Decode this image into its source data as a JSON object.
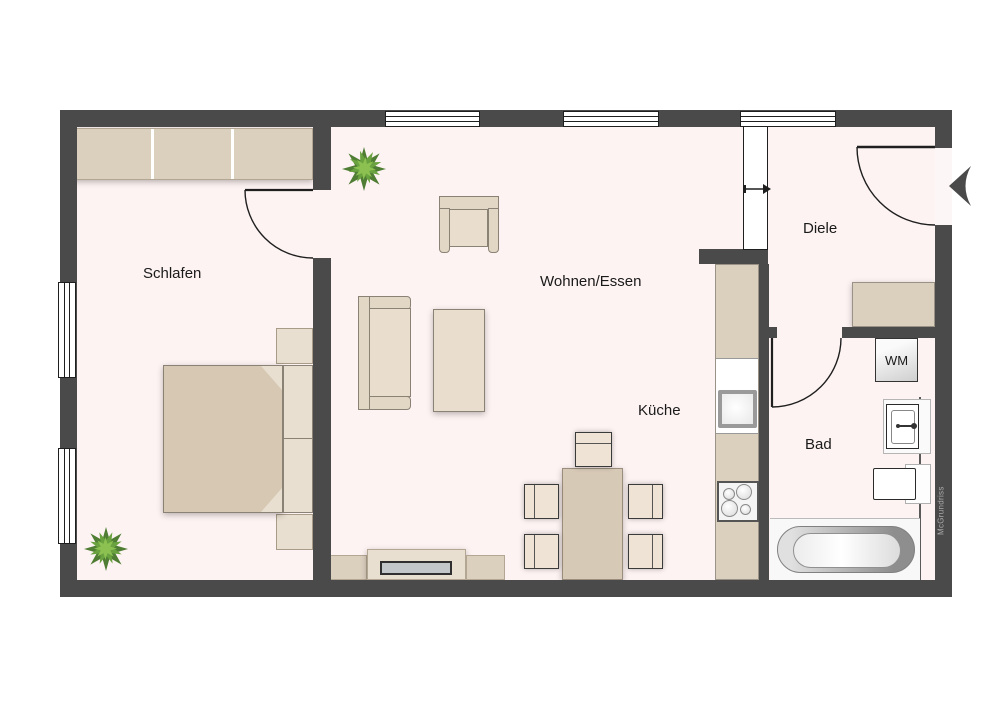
{
  "watermark": "McGrundriss",
  "labels": {
    "schlafen": "Schlafen",
    "wohnen_essen": "Wohnen/Essen",
    "kueche": "Küche",
    "diele": "Diele",
    "bad": "Bad",
    "wm": "WM"
  },
  "colors": {
    "wall": "#4a4a4a",
    "floor": "#fdf3f2",
    "line": "#1f1f1f",
    "beige": "#dbcfbe",
    "beige_light": "#e9decd",
    "frame": "#e2d6c4",
    "blanket": "#d6c8b3",
    "pillow": "#e9dfd0",
    "chair": "#eee3d4",
    "table": "#d6c9b5",
    "soft_border": "#8b8276",
    "beige_border": "#b3a692",
    "plant_dark": "#4e7d33",
    "plant_mid": "#6aa23f",
    "plant_light": "#8cc152",
    "metal": "#9a9a9a",
    "text": "#1a1a1a",
    "watermark": "#ababab"
  }
}
